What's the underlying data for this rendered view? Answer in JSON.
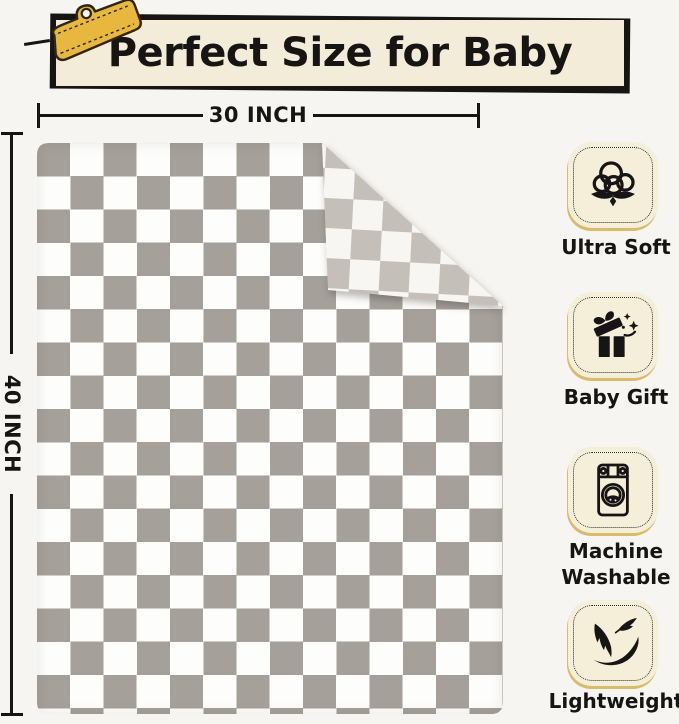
{
  "colors": {
    "page-bg": "#f6f5f2",
    "ink": "#161514",
    "banner-bg": "#f2ecd8",
    "clip-gold": "#e8b83e",
    "clip-outline": "#30260c",
    "blanket-gray": "#a5a099",
    "blanket-white": "#fdfdfc",
    "flap-gray": "#c4c0b9",
    "flap-white": "#f7f6f3",
    "tile-bg": "#f5eed9",
    "tile-gold": "#d9bc6b"
  },
  "banner": {
    "title": "Perfect Size for Baby"
  },
  "dimensions": {
    "width": "30 INCH",
    "height": "40 INCH"
  },
  "blanket": {
    "pattern": "gray and white checkered",
    "square_px": 33
  },
  "features": [
    {
      "icon": "cotton-icon",
      "label": "Ultra Soft"
    },
    {
      "icon": "gift-icon",
      "label": "Baby Gift"
    },
    {
      "icon": "washing-machine-icon",
      "label": "Machine Washable"
    },
    {
      "icon": "feather-icon",
      "label": "Lightweight"
    }
  ]
}
